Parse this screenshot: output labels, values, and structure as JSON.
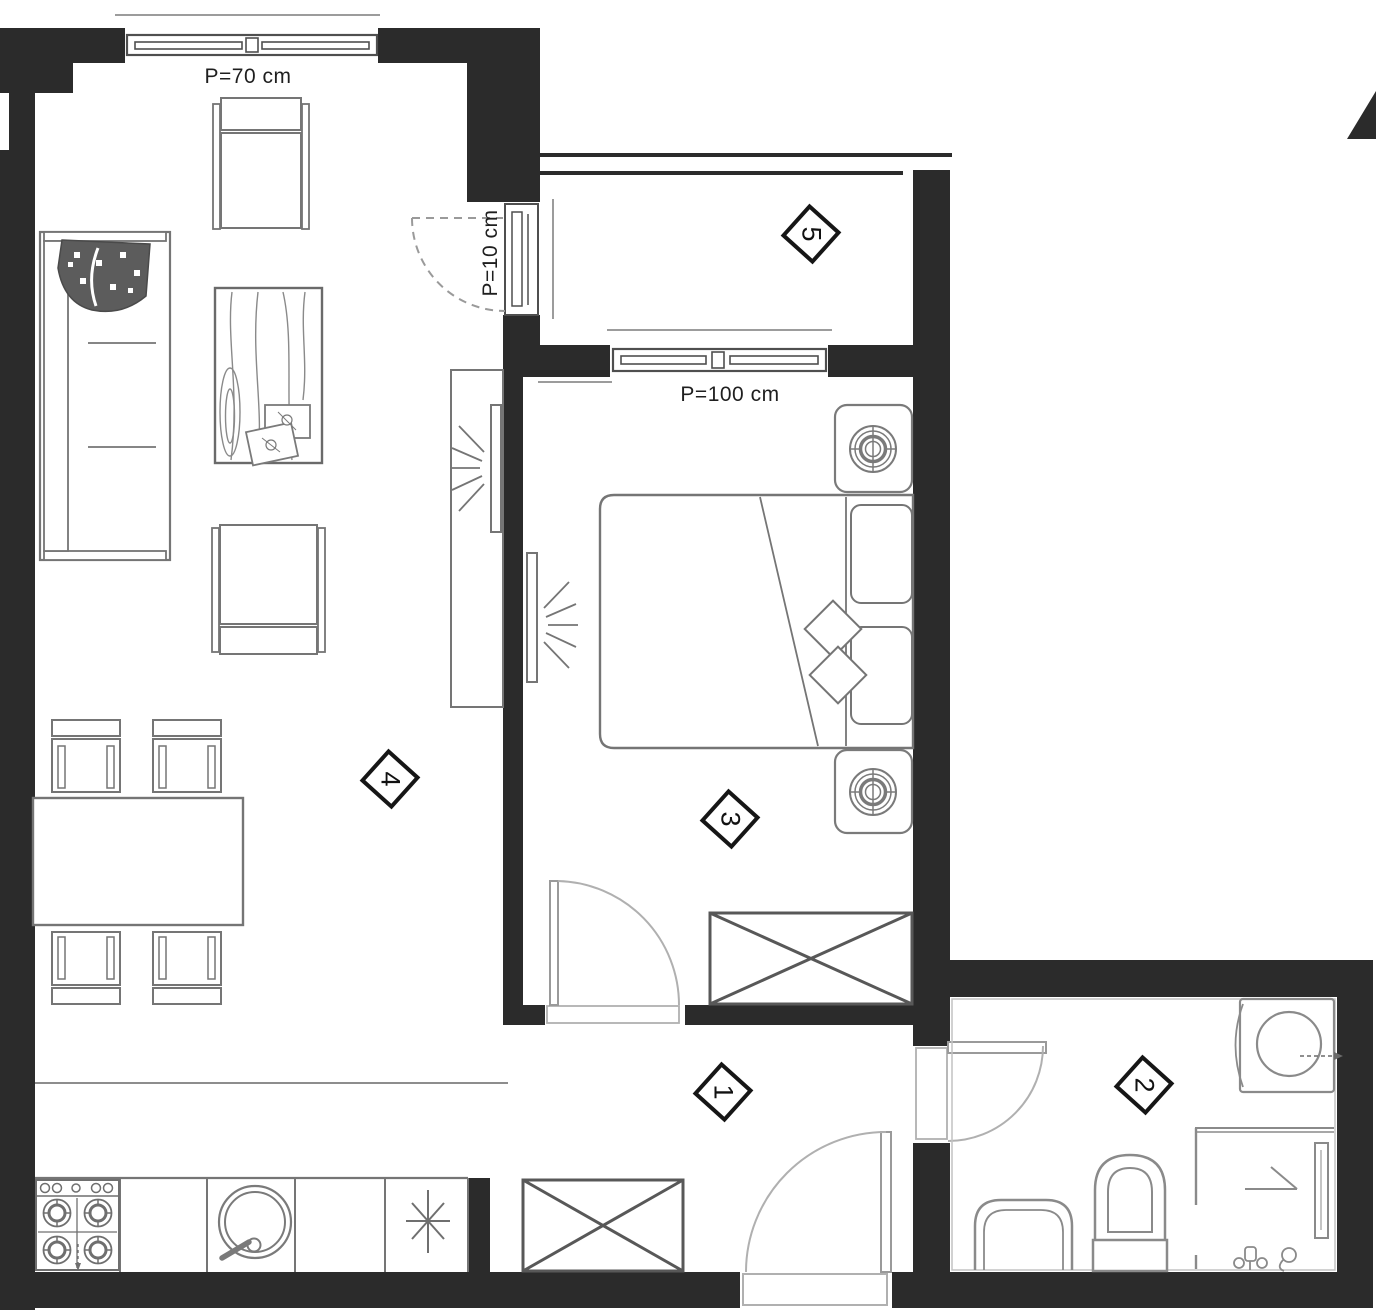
{
  "plan": {
    "window_labels": {
      "p70": "P=70 cm",
      "p10": "P=10 cm",
      "p100": "P=100 cm"
    },
    "rooms": [
      {
        "number": "1"
      },
      {
        "number": "2"
      },
      {
        "number": "3"
      },
      {
        "number": "4"
      },
      {
        "number": "5"
      }
    ],
    "colors": {
      "wall": "#2b2b2b",
      "furniture_line": "#757575",
      "unit_line": "#585858",
      "frame_line": "#4f4f4f",
      "light_line": "#a9a9a9",
      "background": "#ffffff"
    }
  }
}
